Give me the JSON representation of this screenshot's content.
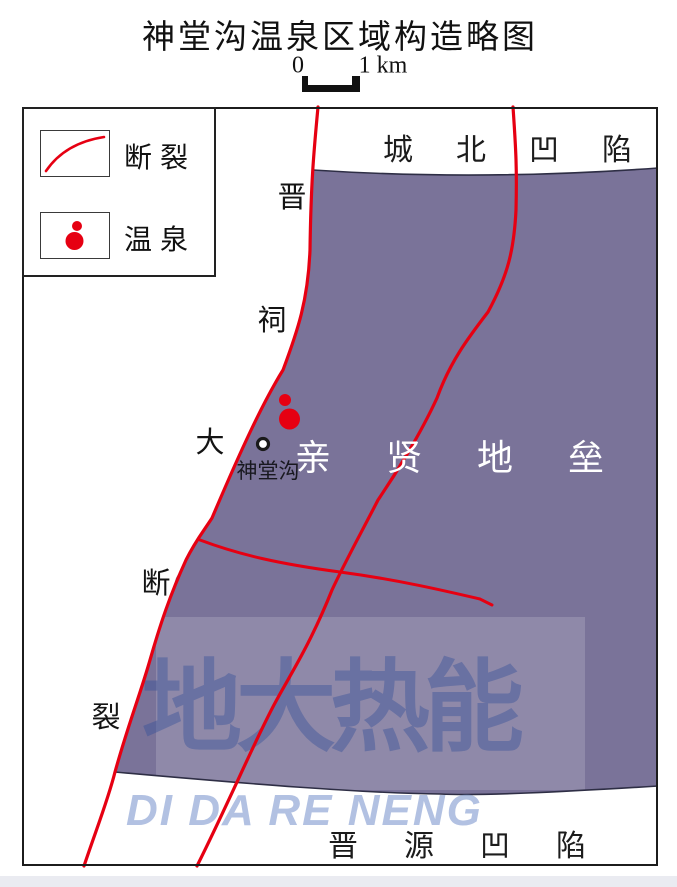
{
  "title": "神堂沟温泉区域构造略图",
  "scale_bar": {
    "start": "0",
    "end": "1 km"
  },
  "legend": {
    "fault_label": "断裂",
    "spring_label": "温泉"
  },
  "map": {
    "regions": {
      "north_depression": "城北凹陷",
      "horst": "亲贤地垒",
      "south_depression": "晋源凹陷"
    },
    "fault_name_chars": [
      "晋",
      "祠",
      "大",
      "断",
      "裂"
    ],
    "spring_point_label": "神堂沟"
  },
  "watermark": {
    "cn": "地大热能",
    "en": "DI DA RE NENG"
  },
  "colors": {
    "fault_red": "#e60012",
    "horst_purple": "#7a7399",
    "boundary_line": "#2e2e45",
    "watermark_blue": "#2f4d98"
  }
}
